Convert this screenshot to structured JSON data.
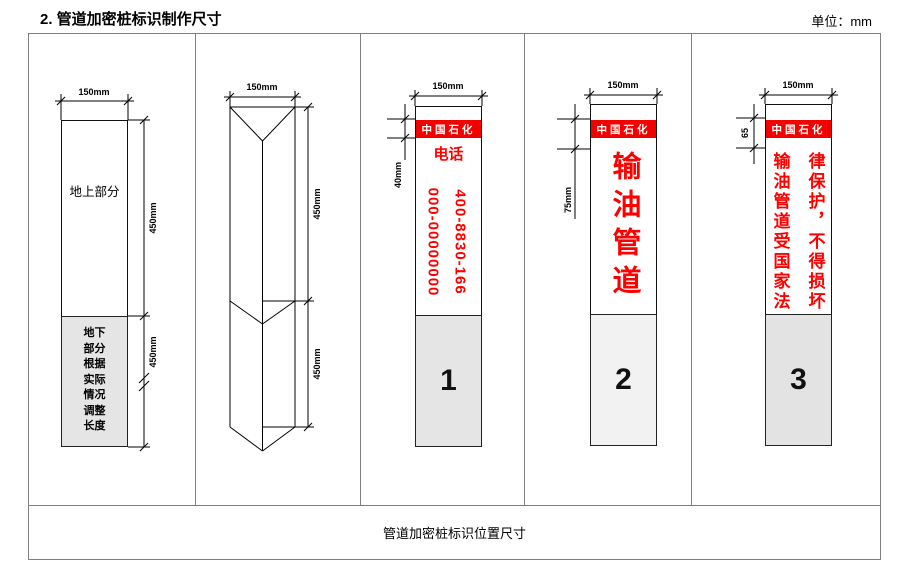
{
  "header": {
    "title": "2. 管道加密桩标识制作尺寸",
    "unit_label": "单位：mm"
  },
  "footer": {
    "caption": "管道加密桩标识位置尺寸"
  },
  "colors": {
    "banner_red": "#f40000",
    "text_red": "#ff0000",
    "underground_gray": "#e5e5e5",
    "box1_gray": "#e5e5e5",
    "box2_gray": "#f2f2f2",
    "box3_gray": "#e3e3e3",
    "line_black": "#000000",
    "border_gray": "#7f7f7f"
  },
  "panels": [
    {
      "name": "front-view",
      "top_dim": "150mm",
      "above_ground_label": "地上部分",
      "below_ground_label": "地下部分根据实际情况调整长度",
      "upper_dim": "450mm",
      "lower_dim": "450mm"
    },
    {
      "name": "prism-view",
      "top_dim": "150mm",
      "upper_dim": "450mm",
      "lower_dim": "450mm"
    },
    {
      "name": "phone-face",
      "top_dim": "150mm",
      "banner": "中国石化",
      "banner_dim": "40mm",
      "phone_label": "电话",
      "phone_number_left": "000-00000000",
      "phone_number_right": "400-8830-166",
      "number": "1"
    },
    {
      "name": "pipeline-face",
      "top_dim": "150mm",
      "banner": "中国石化",
      "banner_dim": "75mm",
      "text": "输油管道",
      "number": "2"
    },
    {
      "name": "law-face",
      "top_dim": "150mm",
      "banner": "中国石化",
      "banner_dim": "65",
      "text_left": "输油管道受国家法",
      "text_right": "律保护，不得损坏",
      "number": "3"
    }
  ]
}
